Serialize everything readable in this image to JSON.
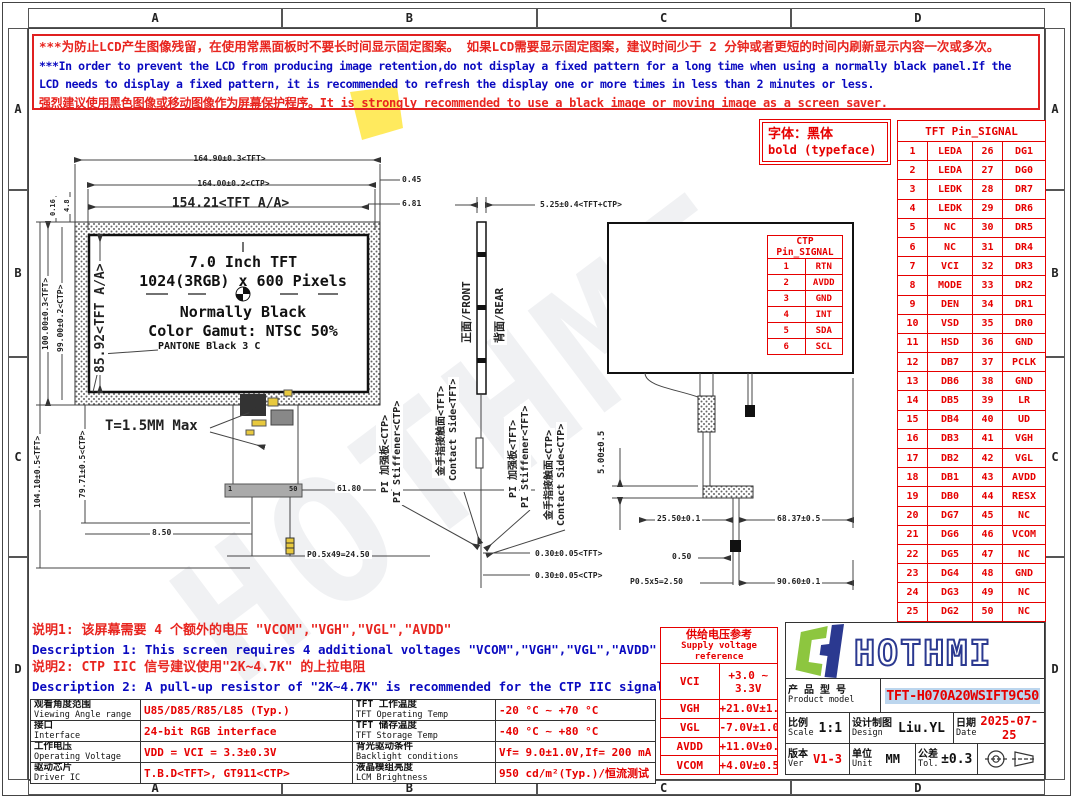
{
  "frame": {
    "top_cols": [
      "A",
      "B",
      "C",
      "D"
    ],
    "bottom_cols": [
      "A",
      "B",
      "C",
      "D"
    ],
    "left_rows": [
      "A",
      "B",
      "C",
      "D"
    ],
    "right_rows": [
      "A",
      "B",
      "C",
      "D"
    ]
  },
  "watermark_text": "HOTHMI",
  "warning": {
    "line1": "***为防止LCD产生图像残留，在使用常黑面板时不要长时间显示固定图案。 如果LCD需要显示固定图案，建议时间少于 2 分钟或者更短的时间内刷新显示内容一次或多次。",
    "line2": "***In order to prevent the LCD from producing image retention,do not display a fixed pattern for a long time when using a normally black panel.If the",
    "line3": "LCD needs to display a fixed pattern, it is recommended to refresh the display one or more times in less than 2 minutes or less.",
    "line4": "强烈建议使用黑色图像或移动图像作为屏幕保护程序。It is strongly recommended to use a black image or moving image as a screen saver."
  },
  "typeface_note": {
    "zh": "字体：黑体",
    "en": "bold (typeface)"
  },
  "front_view": {
    "labels": {
      "size": "7.0 Inch TFT",
      "resolution": "1024(3RGB) x 600 Pixels",
      "mode": "Normally Black",
      "gamut": "Color Gamut: NTSC 50%",
      "pantone": "PANTONE Black 3 C"
    },
    "dims": {
      "width_tft": "164.90±0.3<TFT>",
      "width_ctp": "164.00±0.2<CTP>",
      "width_aa": "154.21<TFT A/A>",
      "offset_045": "0.45",
      "offset_681": "6.81",
      "height_aa": "85.92<TFT A/A>",
      "height_tft": "100.00±0.3<TFT>",
      "height_ctp": "99.00±0.2<CTP>",
      "height_tft2": "104.10±0.5<TFT>",
      "height_ctp2": "79.71±0.5<CTP>",
      "offset_016": "0.16",
      "offset_48": "4.8",
      "thickness": "T=1.5MM Max",
      "tail_width": "61.80",
      "tail_offset": "8.50",
      "tail_pitch": "P0.5x49=24.50",
      "pin_first": "1",
      "pin_last": "50"
    }
  },
  "side_view": {
    "front": "正面/FRONT",
    "rear": "背面/REAR",
    "dim_total": "5.25±0.4<TFT+CTP>",
    "stiffener_ctp_zh": "PI 加强板<CTP>",
    "stiffener_ctp_en": "PI Stiffener<CTP>",
    "contact_tft_zh": "金手指接触面<TFT>",
    "contact_tft_en": "Contact Side<TFT>",
    "stiffener_tft_zh": "PI 加强板<TFT>",
    "stiffener_tft_en": "PI Stiffener<TFT>",
    "contact_ctp_zh": "金手指接触面<CTP>",
    "contact_ctp_en": "Contact Side<CTP>",
    "dim_tft_fpc": "0.30±0.05<TFT>",
    "dim_ctp_fpc": "0.30±0.05<CTP>"
  },
  "rear_view": {
    "dim_height": "5.00±0.5",
    "dim_2550": "25.50±0.1",
    "dim_6837": "68.37±0.5",
    "dim_050": "0.50",
    "dim_pitch": "P0.5x5=2.50",
    "dim_9060": "90.60±0.1"
  },
  "ctp_pin_table": {
    "title": "CTP Pin_SIGNAL",
    "rows": [
      [
        "1",
        "RTN"
      ],
      [
        "2",
        "AVDD"
      ],
      [
        "3",
        "GND"
      ],
      [
        "4",
        "INT"
      ],
      [
        "5",
        "SDA"
      ],
      [
        "6",
        "SCL"
      ]
    ]
  },
  "tft_pin_table": {
    "title": "TFT Pin_SIGNAL",
    "rows": [
      [
        "1",
        "LEDA",
        "26",
        "DG1"
      ],
      [
        "2",
        "LEDA",
        "27",
        "DG0"
      ],
      [
        "3",
        "LEDK",
        "28",
        "DR7"
      ],
      [
        "4",
        "LEDK",
        "29",
        "DR6"
      ],
      [
        "5",
        "NC",
        "30",
        "DR5"
      ],
      [
        "6",
        "NC",
        "31",
        "DR4"
      ],
      [
        "7",
        "VCI",
        "32",
        "DR3"
      ],
      [
        "8",
        "MODE",
        "33",
        "DR2"
      ],
      [
        "9",
        "DEN",
        "34",
        "DR1"
      ],
      [
        "10",
        "VSD",
        "35",
        "DR0"
      ],
      [
        "11",
        "HSD",
        "36",
        "GND"
      ],
      [
        "12",
        "DB7",
        "37",
        "PCLK"
      ],
      [
        "13",
        "DB6",
        "38",
        "GND"
      ],
      [
        "14",
        "DB5",
        "39",
        "LR"
      ],
      [
        "15",
        "DB4",
        "40",
        "UD"
      ],
      [
        "16",
        "DB3",
        "41",
        "VGH"
      ],
      [
        "17",
        "DB2",
        "42",
        "VGL"
      ],
      [
        "18",
        "DB1",
        "43",
        "AVDD"
      ],
      [
        "19",
        "DB0",
        "44",
        "RESX"
      ],
      [
        "20",
        "DG7",
        "45",
        "NC"
      ],
      [
        "21",
        "DG6",
        "46",
        "VCOM"
      ],
      [
        "22",
        "DG5",
        "47",
        "NC"
      ],
      [
        "23",
        "DG4",
        "48",
        "GND"
      ],
      [
        "24",
        "DG3",
        "49",
        "NC"
      ],
      [
        "25",
        "DG2",
        "50",
        "NC"
      ]
    ]
  },
  "notes": {
    "note1_zh": "说明1: 该屏幕需要 4 个额外的电压 \"VCOM\",\"VGH\",\"VGL\",\"AVDD\"",
    "note1_en": "Description 1: This screen requires 4 additional voltages \"VCOM\",\"VGH\",\"VGL\",\"AVDD\"",
    "note2_zh": "说明2: CTP IIC 信号建议使用\"2K~4.7K\" 的上拉电阻",
    "note2_en": "Description 2: A pull-up resistor of \"2K~4.7K\" is recommended for the CTP IIC signal."
  },
  "supply_table": {
    "title_zh": "供给电压参考",
    "title_en": "Supply voltage reference",
    "rows": [
      [
        "VCI",
        "+3.0 ~ 3.3V"
      ],
      [
        "VGH",
        "+21.0V±1.0V"
      ],
      [
        "VGL",
        "-7.0V±1.0V"
      ],
      [
        "AVDD",
        "+11.0V±0.3V"
      ],
      [
        "VCOM",
        "+4.0V±0.5V"
      ]
    ]
  },
  "spec_table": {
    "rows": [
      {
        "l1z": "观看角度范围",
        "l1e": "Viewing Angle range",
        "v1": "U85/D85/R85/L85 (Typ.)",
        "l2z": "TFT 工作温度",
        "l2e": "TFT Operating Temp",
        "v2": "-20 °C ~ +70 °C"
      },
      {
        "l1z": "接口",
        "l1e": "Interface",
        "v1": "24-bit RGB interface",
        "l2z": "TFT 储存温度",
        "l2e": "TFT Storage Temp",
        "v2": "-40 °C ~ +80 °C"
      },
      {
        "l1z": "工作电压",
        "l1e": "Operating Voltage",
        "v1": "VDD = VCI = 3.3±0.3V",
        "l2z": "背光驱动条件",
        "l2e": "Backlight conditions",
        "v2": "Vf= 9.0±1.0V,If= 200 mA"
      },
      {
        "l1z": "驱动芯片",
        "l1e": "Driver IC",
        "v1": "T.B.D<TFT>, GT911<CTP>",
        "l2z": "液晶模组亮度",
        "l2e": "LCM Brightness",
        "v2": "950 cd/m²(Typ.)/恒流测试"
      }
    ]
  },
  "title_block": {
    "brand": "HOTHMI",
    "product_label_zh": "产 品 型 号",
    "product_label_en": "Product model",
    "product_model": "TFT-H070A20WSIFT9C50",
    "scale_zh": "比例",
    "scale_en": "Scale",
    "scale": "1:1",
    "design_zh": "设计制图",
    "design_en": "Design",
    "design": "Liu.YL",
    "date_zh": "日期",
    "date_en": "Date",
    "date": "2025-07-25",
    "ver_zh": "版本",
    "ver_en": "Ver",
    "ver": "V1-3",
    "unit_zh": "单位",
    "unit_en": "Unit",
    "unit": "MM",
    "tol_zh": "公差",
    "tol_en": "Tol.",
    "tol": "±0.3"
  }
}
